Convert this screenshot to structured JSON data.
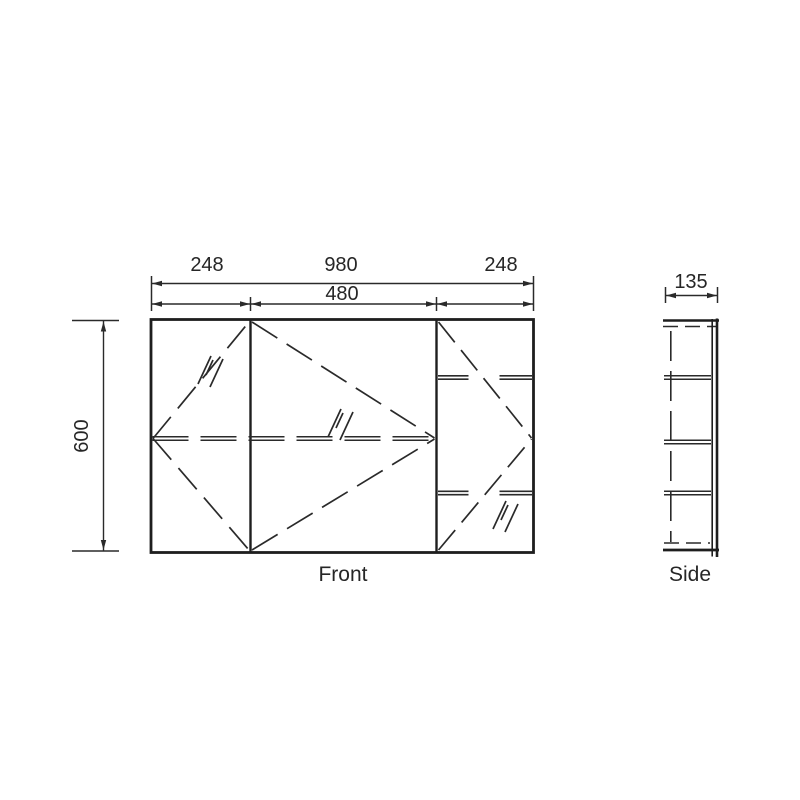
{
  "drawing": {
    "background_color": "#ffffff",
    "line_color": "#1e1e1e",
    "text_color": "#262626",
    "front_view": {
      "caption": "Front",
      "dimensions": {
        "top_segments": [
          "248",
          "980",
          "248"
        ],
        "middle_section_width": "480",
        "height": "600"
      },
      "features": [
        "three-panel mirrored cabinet",
        "dashed door swing lines",
        "double-line shelf edges",
        "mirror glass hatch marks"
      ]
    },
    "side_view": {
      "caption": "Side",
      "dimensions": {
        "depth": "135"
      },
      "features": [
        "section with four shelf levels",
        "hidden dashed edges",
        "door panel double line on right"
      ]
    }
  }
}
